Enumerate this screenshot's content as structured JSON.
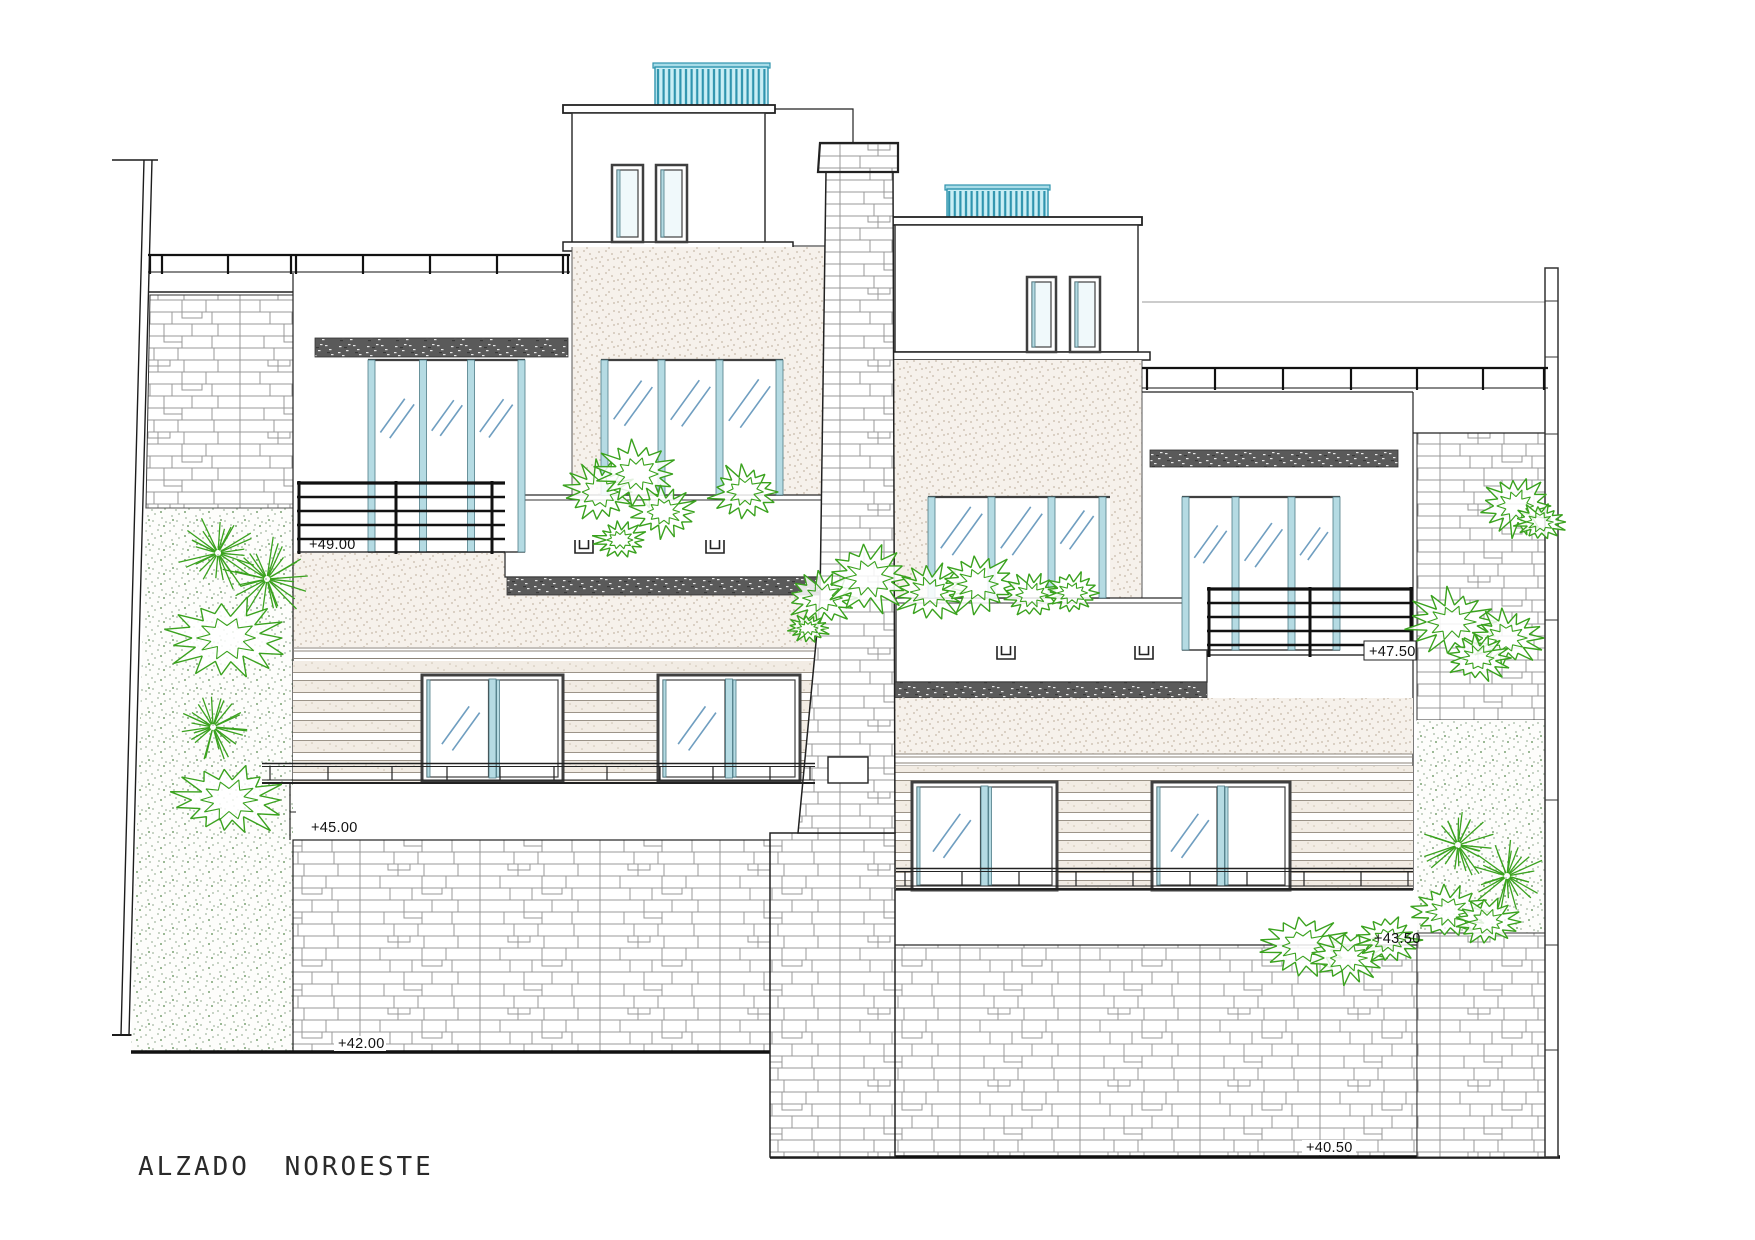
{
  "drawing": {
    "title": "ALZADO NOROESTE"
  },
  "elevation_markers": {
    "left_upper": "+49.00",
    "left_mid": "+45.00",
    "left_base": "+42.00",
    "right_upper": "+47.50",
    "right_mid": "+43.50",
    "right_base": "+40.50"
  },
  "colors": {
    "vegetation": "#3aa21e",
    "glass": "#b5dbe3",
    "reflection": "#6f9ec0",
    "pergola_fill": "#c9eef5",
    "pergola_stripe": "#2f94ae",
    "ink": "#1c1c1c"
  }
}
